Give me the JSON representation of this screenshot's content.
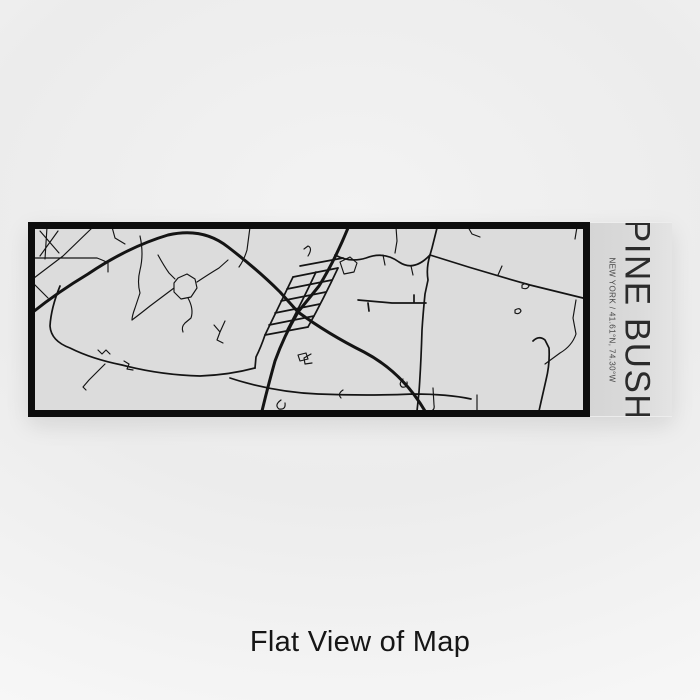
{
  "page": {
    "caption": "Flat View of Map"
  },
  "product": {
    "panel": {
      "title": "PINE BUSH",
      "subtitle": "NEW YORK / 41.61°N, 74.30°W"
    },
    "map": {
      "bg_color": "#dcdcdc",
      "border_color": "#0d0d0d",
      "road_color": "#141414",
      "roads_thick": [
        "M320 6 Q306 40 291 64 L270 90 Q256 114 247 139 Q240 164 234 189",
        "M5 90 Q30 70 60 52 Q100 25 140 13 Q175 5 200 25 Q230 48 252 70 L270 90",
        "M270 90 Q300 112 336 130 Q374 150 397 189"
      ],
      "roads_medium": [
        "M265 55 L310 46 M259 67 L304 58 M253 79 L298 70 M247 91 L292 82 M241 103 L286 94 M237 113 L280 105 M272 44 L315 36",
        "M265 55 Q251 84 237 113 M310 46 Q296 76 280 105 M288 50 Q274 80 259 108",
        "M237 113 Q233 125 228 135 L227 146",
        "M330 78 L364 81 L398 81 M340 81 L341 89 M386 81 L386 73",
        "M409 6 L404 26 L402 33 Q398 46 400 58 L397 72 Q395 92 394 108 Q393 142 391 170 L389 189",
        "M402 33 Q452 49 502 63 Q530 70 559 77",
        "M307 33 Q322 41 338 36 Q356 29 371 40 Q386 50 402 33",
        "M32 64 Q23 86 22 104 Q23 119 42 126 Q64 137 94 143 Q132 153 172 154 Q201 153 227 146",
        "M202 156 Q245 170 290 172 Q340 174 385 172 Q420 172 443 177",
        "M505 119 Q511 113 517 118 L521 126 Q522 142 518 158 L513 180 L511 189"
      ],
      "roads_thin": [
        "M12 9 L31 31 M30 9 L12 34 M19 5 L17 37 M6 36 L69 36 M65 5 L35 34 L6 56 M69 36 Q77 39 80 41 L80 50",
        "M84 5 L87 16 L97 22",
        "M5 61 L20 76",
        "M112 14 Q116 32 112 48 Q109 60 112 71 L107 86 Q104 94 104 98",
        "M222 5 L219 28 Q216 38 211 45",
        "M150 56 L159 52 L167 57 L169 66 L163 75 L153 77 L146 70 L146 61 Z M122 84 L146 66 M130 33 Q136 44 141 51 L147 57 M160 76 Q166 87 163 96 L157 101 Q153 105 155 110 M169 60 Q181 52 191 46 L200 38 M122 84 Q112 92 104 98",
        "M186 103 L192 110 M197 99 L192 110 L189 118 L195 121",
        "M77 142 L61 158 L55 165 L58 168",
        "M70 128 L74 132 L78 128 L82 132 M96 139 L101 142 L99 147 L105 148",
        "M368 5 L369 19 L367 31 M440 5 L444 12 L452 15",
        "M549 5 L547 17",
        "M548 78 L545 96 L548 112 Q544 124 532 131 L517 142",
        "M312 40 L322 35 L329 41 L326 50 L316 52 Z M280 34 Q285 26 280 24 L276 27 M283 132 L276 136 L277 142 L284 141 M270 133 L278 131 L280 137 L272 139 Z",
        "M470 53 L474 44 M494 63 Q499 60 501 64 Q499 68 494 66 Z M487 88 Q492 85 493 89 Q491 93 487 91 Z",
        "M405 166 L406 183 Q407 188 403 189 M449 173 L449 189 M375 157 Q370 162 374 165 Q380 166 379 160 M253 178 Q246 183 251 187 Q258 188 257 181 M315 168 Q309 172 313 176",
        "M355 33 L357 43 M383 44 L385 53"
      ]
    }
  }
}
